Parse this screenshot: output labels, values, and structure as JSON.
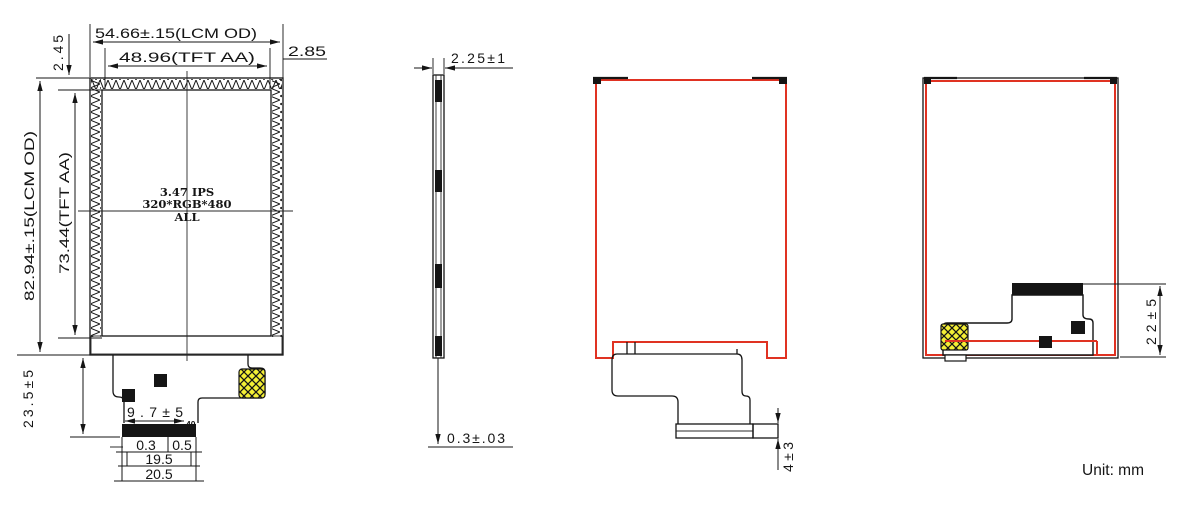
{
  "unit_label": "Unit: mm",
  "front": {
    "dim_lcm_width": "54.66±.15(LCM OD)",
    "dim_aa_width": "48.96(TFT AA)",
    "dim_top_left": "2.45",
    "dim_top_right": "2.85",
    "dim_lcm_height": "82.94±.15(LCM OD)",
    "dim_aa_height": "73.44(TFT AA)",
    "dim_fpc_length": "23.5±5",
    "label_line1": "3.47 IPS",
    "label_line2": "320*RGB*480",
    "label_line3": "ALL",
    "dim_fpc_offset": "9.7±5",
    "pin_count": "40",
    "dim_pin_pitch": "0.3",
    "dim_pin_width": "0.5",
    "dim_contact_width": "19.5",
    "dim_fpc_width": "20.5"
  },
  "side": {
    "dim_thickness": "2.25±1",
    "dim_fpc_thickness": "0.3±.03"
  },
  "back": {
    "dim_connector_height": "4±3"
  },
  "folded": {
    "dim_fpc_fold": "22±5"
  },
  "colors": {
    "line": "#151515",
    "red": "#e03222",
    "yellow": "#f4ef35"
  }
}
